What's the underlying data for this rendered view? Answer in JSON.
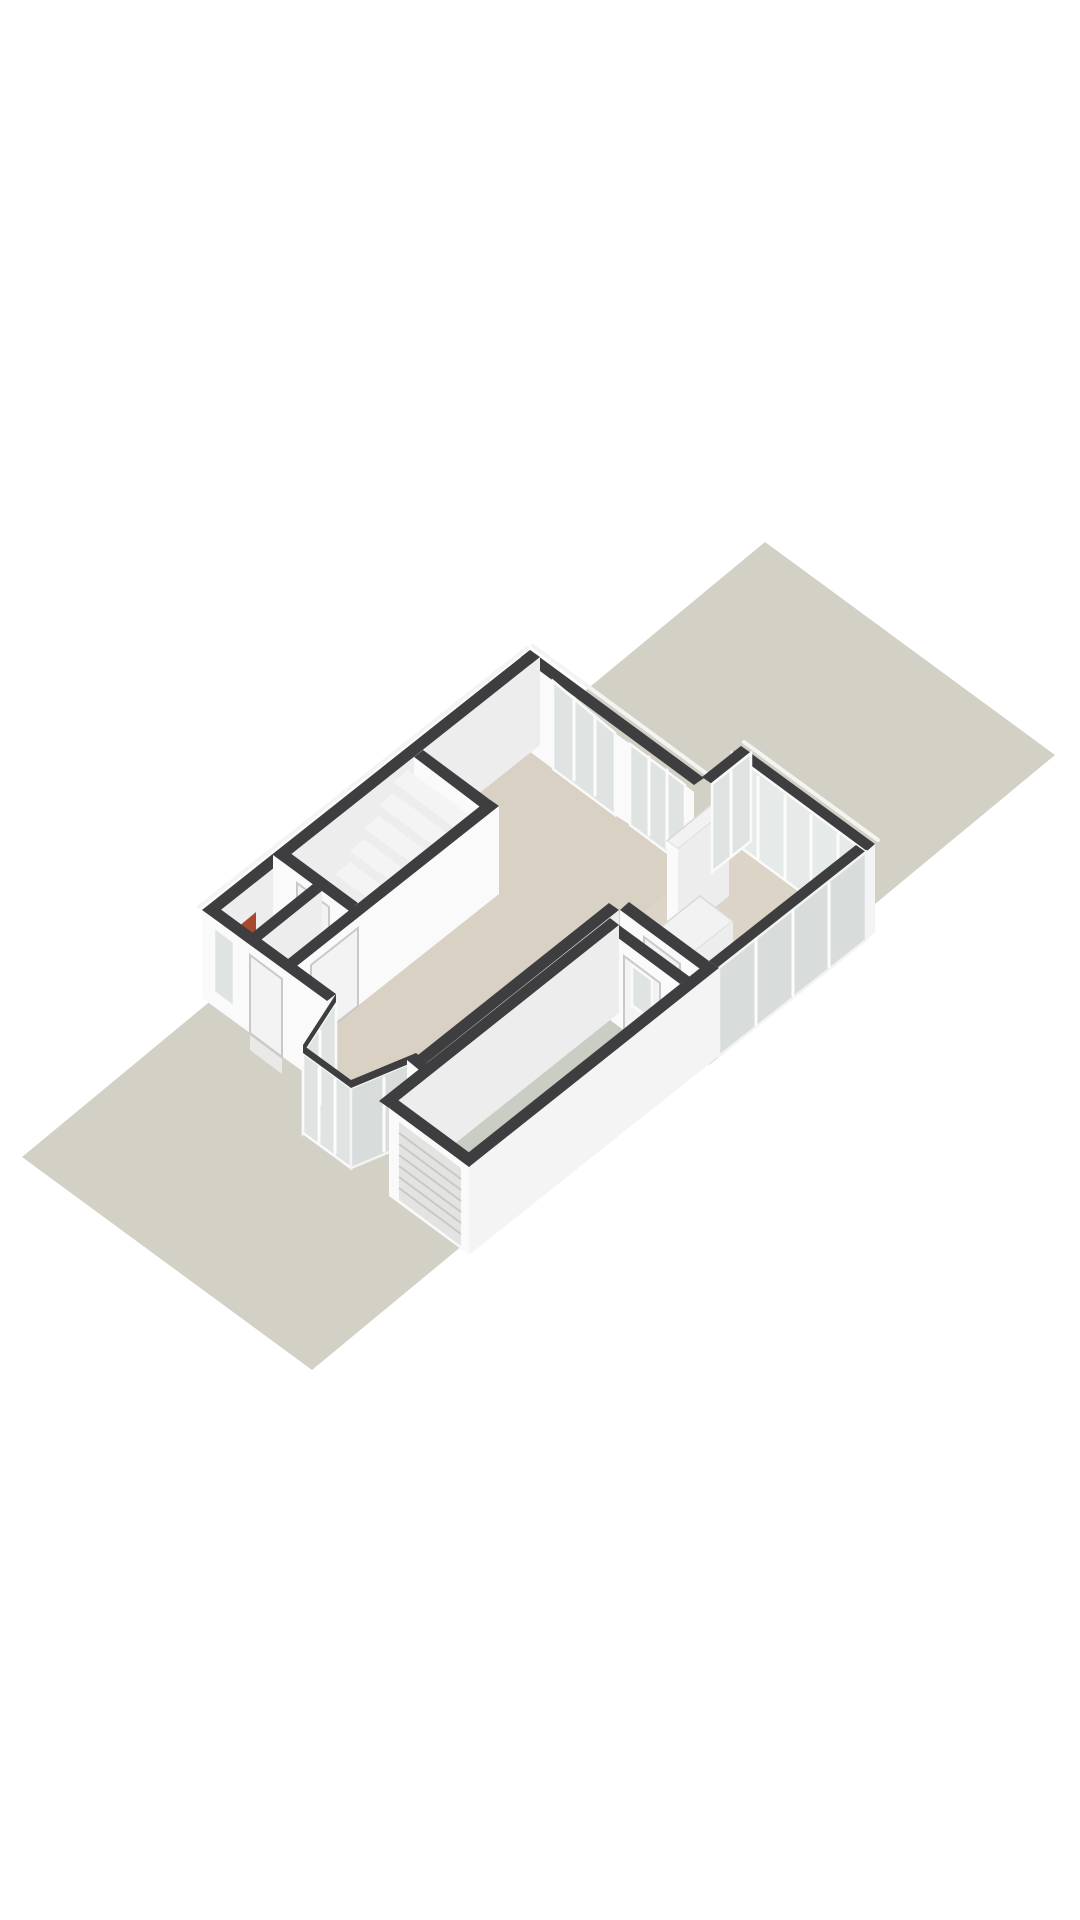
{
  "meta": {
    "title": "3D floor plan render — ground floor on plot",
    "description": "Isometric 3D render of a ground floor plan placed on a grey rectangular plot: white walls with dark cut tops, beige living floors, glazed garden annex at the rear, bay window and front door at the street side, staircase hall with toilet, and an attached garage with grey floor and roller door. No text is rendered in the image."
  },
  "palette": {
    "background": "#ffffff",
    "plot": "#d3d1c6",
    "floor_main": "#d9d1c3",
    "floor_annex": "#dcd5c7",
    "floor_garage": "#c9cdc4",
    "bay_sill": "#e1d8ca",
    "wall_cap": "#3e3e41",
    "wall_bright": "#fafafb",
    "wall_shade": "#ededee",
    "wall_mid": "#f4f4f5",
    "glass_inner": "#dfe4e3",
    "glass_outer": "#d8dddc",
    "glass_annex": "#e6eae9",
    "door": "#f3f3f4",
    "mullion": "#fcfcfc",
    "roller_slat": "#c8c8c6",
    "radiator": "#a8492f",
    "step": "#e9e9e7"
  }
}
